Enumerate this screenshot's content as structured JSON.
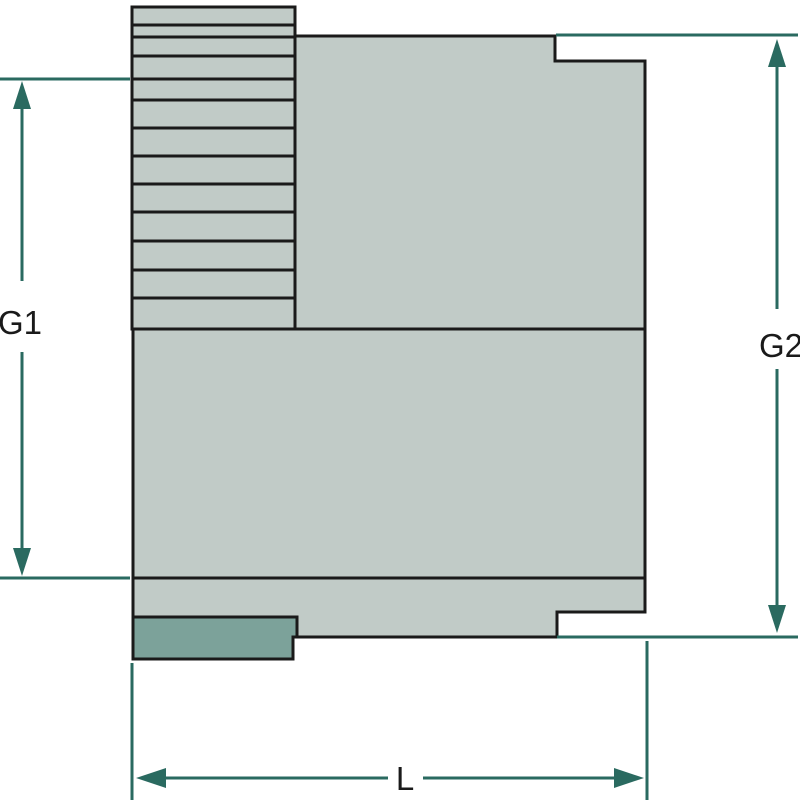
{
  "diagram": {
    "labels": {
      "g1": "G1",
      "g2": "G2",
      "l": "L"
    },
    "colors": {
      "background": "#ffffff",
      "body_fill": "#c1cbc7",
      "collar_fill": "#7ca29a",
      "outline": "#1a1a1a",
      "dimension": "#2a6a60",
      "label_text": "#1a1a1a"
    }
  }
}
